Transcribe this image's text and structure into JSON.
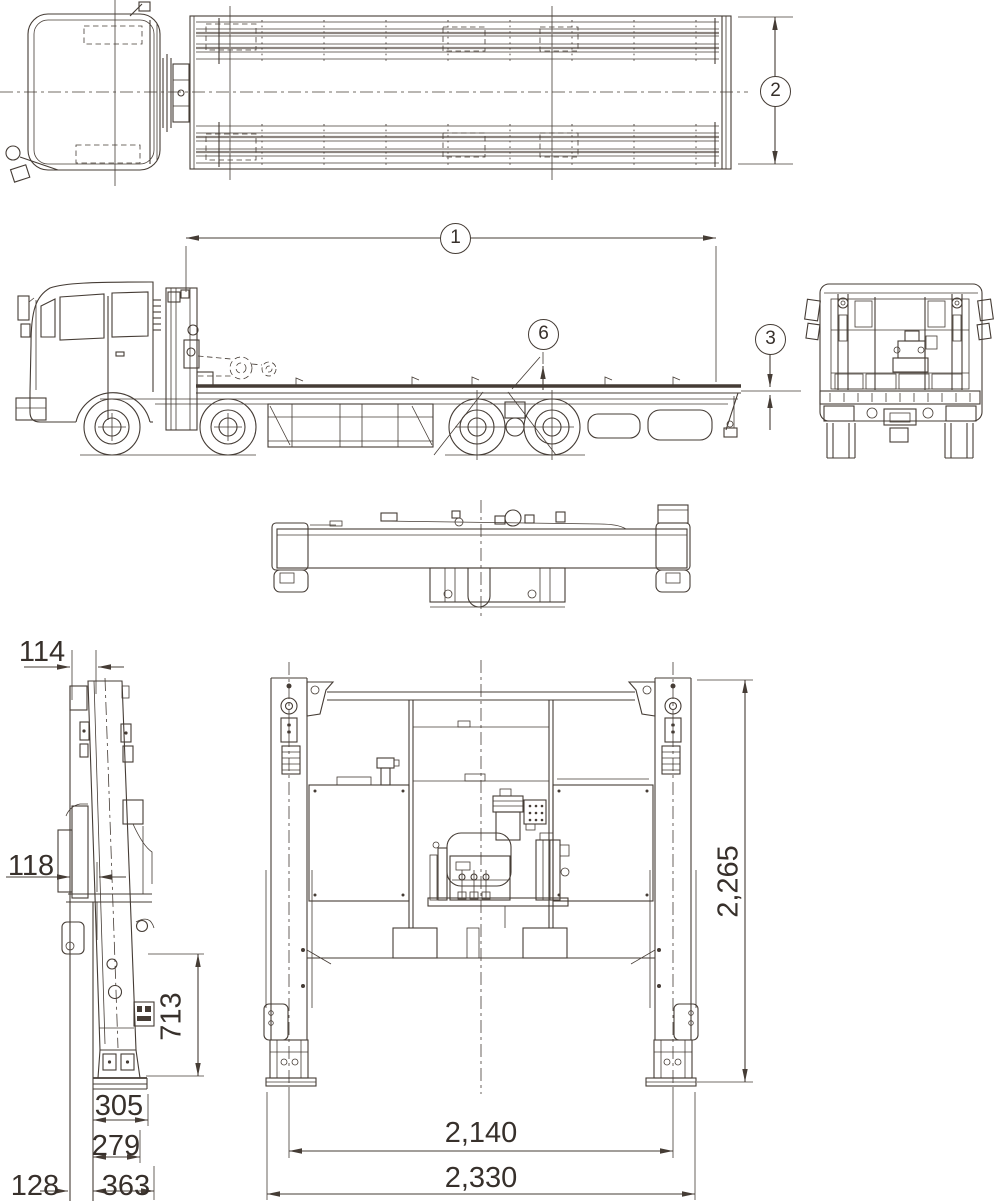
{
  "balloon_labels": {
    "overall_length": "1",
    "bed_width": "2",
    "deck_height": "3",
    "deck_marker": "6"
  },
  "dimensions": {
    "mast": {
      "top_width": "114",
      "mid_width": "118",
      "leg_height": "713",
      "pad_width": "305",
      "foot_width": "279",
      "side_offset": "128",
      "base_width": "363"
    },
    "lift_frame": {
      "overall_height": "2,265",
      "leg_center_span": "2,140",
      "overall_width": "2,330"
    }
  },
  "colors": {
    "line": "#453c35",
    "text": "#37302b",
    "background": "#ffffff",
    "slat_gray": "#8d8681"
  }
}
